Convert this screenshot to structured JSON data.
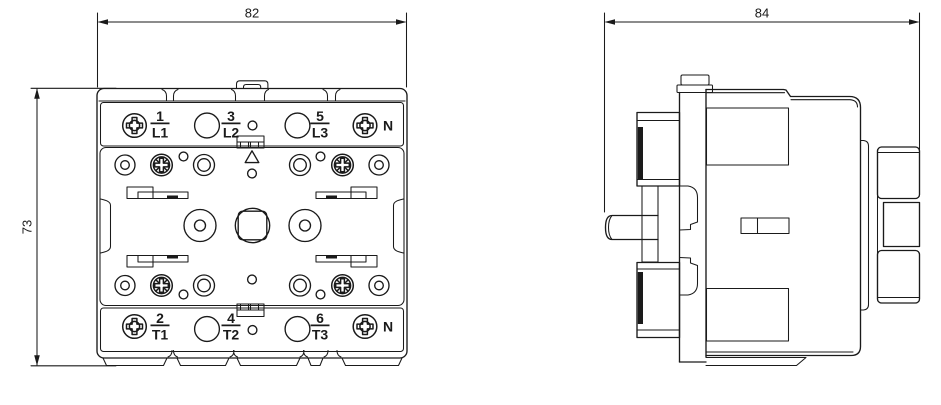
{
  "colors": {
    "line": "#1a1a1a",
    "background": "#ffffff"
  },
  "dimensions": {
    "front_width": "82",
    "front_height": "73",
    "side_width": "84"
  },
  "front_view": {
    "top_terminals": [
      {
        "pin": "1",
        "label": "L1"
      },
      {
        "pin": "3",
        "label": "L2"
      },
      {
        "pin": "5",
        "label": "L3"
      },
      {
        "pin": "",
        "label": "N"
      }
    ],
    "bottom_terminals": [
      {
        "pin": "2",
        "label": "T1"
      },
      {
        "pin": "4",
        "label": "T2"
      },
      {
        "pin": "6",
        "label": "T3"
      },
      {
        "pin": "",
        "label": "N"
      }
    ]
  }
}
